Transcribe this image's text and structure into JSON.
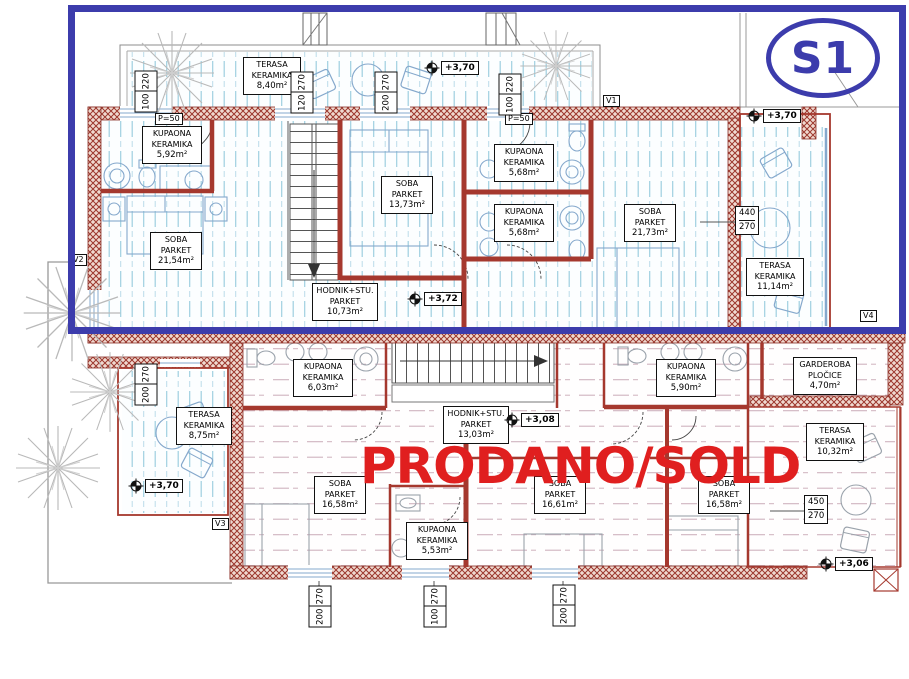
{
  "unit_badge": {
    "label": "S1"
  },
  "sold_overlay": {
    "text": "PRODANO/SOLD"
  },
  "colors": {
    "frame_blue": "#3c3cac",
    "sold_red": "#e01f1f",
    "wall_red": "#9c372d",
    "floor_hatch_blue": "#9ecfe0",
    "floor_hatch_pink": "#cfb2be"
  },
  "upper_unit": {
    "rooms": [
      {
        "l1": "TERASA",
        "l2": "KERAMIKA",
        "l3": "8,40m²"
      },
      {
        "l1": "KUPAONA",
        "l2": "KERAMIKA",
        "l3": "5,92m²"
      },
      {
        "l1": "SOBA",
        "l2": "PARKET",
        "l3": "21,54m²"
      },
      {
        "l1": "SOBA",
        "l2": "PARKET",
        "l3": "13,73m²"
      },
      {
        "l1": "KUPAONA",
        "l2": "KERAMIKA",
        "l3": "5,68m²"
      },
      {
        "l1": "KUPAONA",
        "l2": "KERAMIKA",
        "l3": "5,68m²"
      },
      {
        "l1": "SOBA",
        "l2": "PARKET",
        "l3": "21,73m²"
      },
      {
        "l1": "HODNIK+STU.",
        "l2": "PARKET",
        "l3": "10,73m²"
      },
      {
        "l1": "TERASA",
        "l2": "KERAMIKA",
        "l3": "11,14m²"
      }
    ],
    "door_labels": [
      "P=50",
      "P=50"
    ],
    "levels": [
      "+3,70",
      "+3,70",
      "+3,72"
    ]
  },
  "lower_unit": {
    "rooms": [
      {
        "l1": "KUPAONA",
        "l2": "KERAMIKA",
        "l3": "6,03m²"
      },
      {
        "l1": "HODNIK+STU.",
        "l2": "PARKET",
        "l3": "13,03m²"
      },
      {
        "l1": "SOBA",
        "l2": "PARKET",
        "l3": "16,58m²"
      },
      {
        "l1": "KUPAONA",
        "l2": "KERAMIKA",
        "l3": "5,53m²"
      },
      {
        "l1": "SOBA",
        "l2": "PARKET",
        "l3": "16,61m²"
      },
      {
        "l1": "SOBA",
        "l2": "PARKET",
        "l3": "16,58m²"
      },
      {
        "l1": "KUPAONA",
        "l2": "KERAMIKA",
        "l3": "5,90m²"
      },
      {
        "l1": "GARDEROBA",
        "l2": "PLOČICE",
        "l3": "4,70m²"
      },
      {
        "l1": "TERASA",
        "l2": "KERAMIKA",
        "l3": "10,32m²"
      },
      {
        "l1": "TERASA",
        "l2": "KERAMIKA",
        "l3": "8,75m²"
      }
    ],
    "levels": [
      "+3,70",
      "+3,08",
      "+3,06"
    ]
  },
  "vent_labels": [
    "V1",
    "V2",
    "V3",
    "V4"
  ],
  "dims_rotated": [
    {
      "a": "100",
      "b": "220"
    },
    {
      "a": "120",
      "b": "270"
    },
    {
      "a": "200",
      "b": "270"
    },
    {
      "a": "100",
      "b": "220"
    },
    {
      "a": "200",
      "b": "270"
    },
    {
      "a": "200",
      "b": "270"
    },
    {
      "a": "100",
      "b": "270"
    },
    {
      "a": "200",
      "b": "270"
    }
  ],
  "dims_fraction": [
    {
      "a": "440",
      "b": "270"
    },
    {
      "a": "450",
      "b": "270"
    }
  ]
}
